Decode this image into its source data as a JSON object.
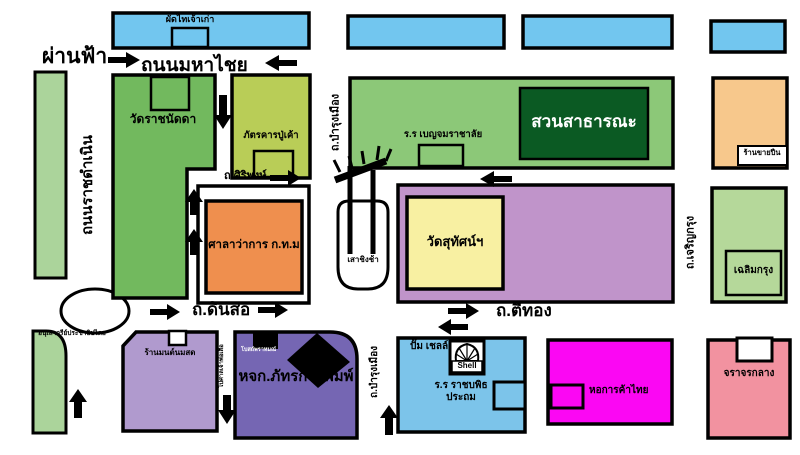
{
  "streets": {
    "phan_fa": "ผ่านฟ้า",
    "maha_chai": "ถนนมหาไชย",
    "ratchadamnoen": "ถนนราชดำเนิน",
    "siri_phong": "ถ.ศิริพงษ์",
    "dinso": "ถ.ดินสอ",
    "bamrung_mueang_top": "ถ.บำรุงเมือง",
    "bamrung_mueang_bottom": "ถ.บำรุงเมือง",
    "ti_thong": "ถ.ตีทอง",
    "charoen_krung": "ถ.เจริญกรุง",
    "lane_to_shrine": "ไปศาลเจ้าพ่อเสือ"
  },
  "places": {
    "pad_thai_shop": "ผัดไทเจ้าเก่า",
    "wat_ratchanatda": "วัดราชนัดดา",
    "pu_kao_restaurant": "ภัตรคารปู่เค้า",
    "city_hall": "ศาลาว่าการ ก.ท.ม",
    "democracy_monument": "อนุเสาวรีย์ประชาธิปไตย",
    "public_park": "สวนสาธารณะ",
    "benjamarachalai_school": "ร.ร เบญจมราชาลัย",
    "giant_swing": "เสาชิงช้า",
    "wat_suthat": "วัดสุทัศน์ฯ",
    "gun_shop": "ร้านขายปืน",
    "chalerm_krung": "เฉลิมกรุง",
    "central_traffic": "จราจรกลาง",
    "mont_milk_shop": "ร้านมนต์นมสด",
    "brahmin_temple": "โบสถ์พราหมณ์",
    "phattra_printing": "หจก.ภัทรการพิมพ์",
    "shell_station": "ปั๊ม เชลล์",
    "shell_logo_text": "Shell",
    "rajabopit_school_line1": "ร.ร ราชบพิธ",
    "rajabopit_school_line2": "ประถม",
    "thai_chamber_of_commerce": "หอการค้าไทย"
  },
  "colors": {
    "sky_blue_block": "#72c6ef",
    "light_green_strip": "#abd49b",
    "medium_green_block": "#72b95e",
    "park_green": "#8cc878",
    "park_inner_dark_green": "#0b5a23",
    "yellow_green_block": "#b9cd57",
    "orange_city_hall": "#ef8f4e",
    "tan_orange_block": "#f7c88c",
    "purple_block": "#c094ca",
    "yellow_temple_block": "#f8f0a2",
    "light_purple_block": "#b09ace",
    "dark_purple_block": "#7566b3",
    "magenta_block": "#fb07f3",
    "pink_block": "#f292a0",
    "outline": "#000000",
    "road": "#ffffff"
  }
}
